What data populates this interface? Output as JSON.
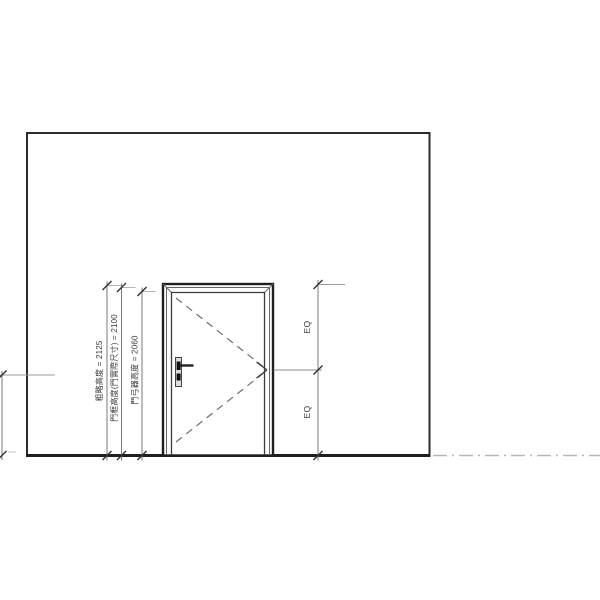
{
  "drawing": {
    "kind": "door-elevation",
    "dimension_labels": {
      "rough_height": "粗略高度 = 2125",
      "frame_height": "門框高度(門實際尺寸) = 2100",
      "closer_height": "門弓器高度 = 2060"
    },
    "dimension_values": {
      "rough_height": 2125,
      "frame_height": 2100,
      "closer_height": 2060
    },
    "eq_labels": [
      "EQ",
      "EQ"
    ],
    "colors": {
      "background": "#ffffff",
      "wall_line": "#2a2a2a",
      "door_line": "#1f1f1f",
      "thin_line": "#666666",
      "dimension_line": "#7a7a7a",
      "tick": "#2f2f2f",
      "swing_dash": "#6e6e6e",
      "centerline": "#b8b8b8",
      "text": "#3a3a3a"
    }
  }
}
